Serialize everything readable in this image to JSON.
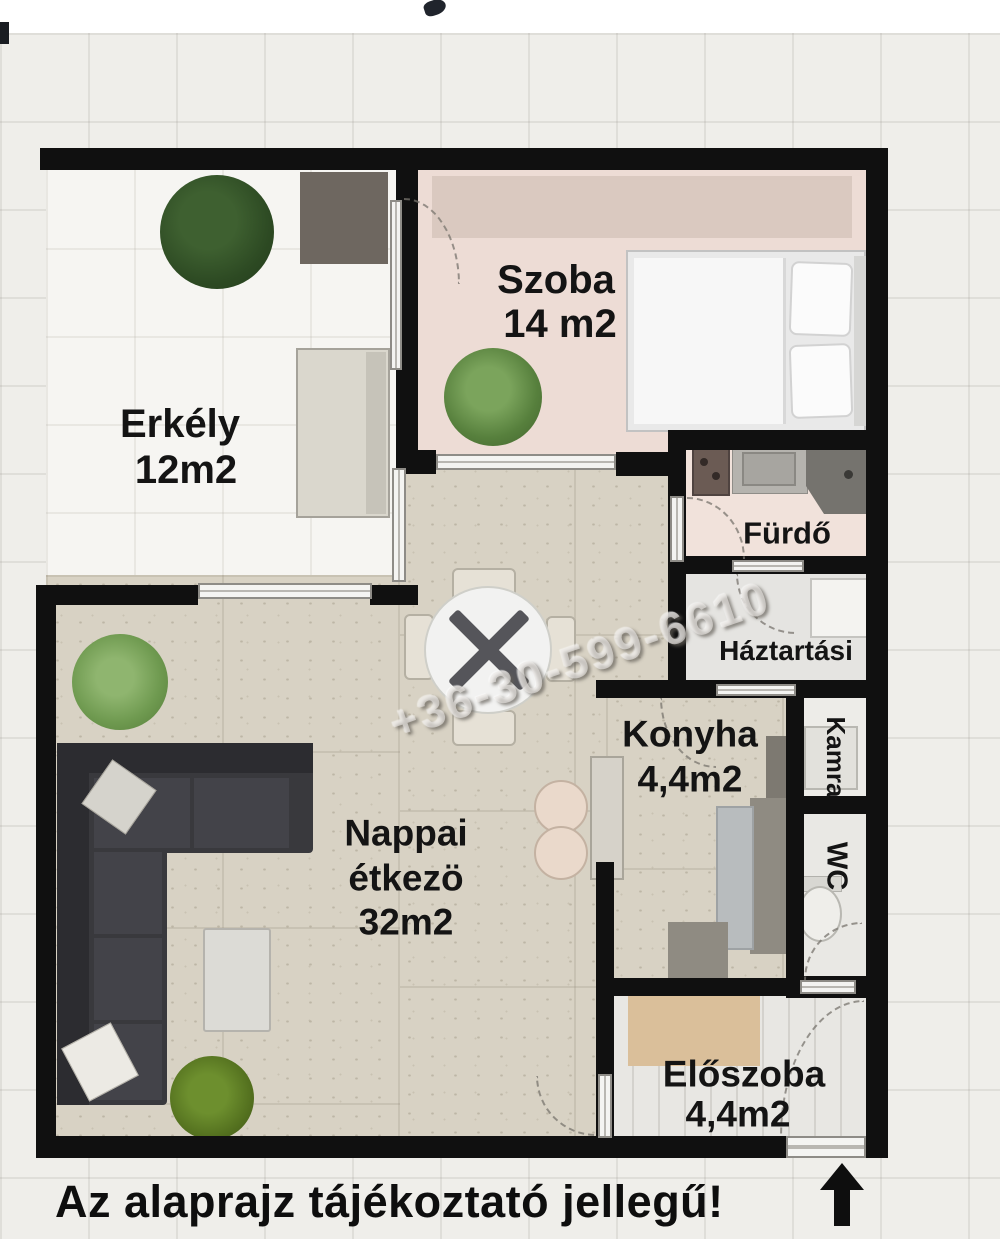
{
  "rooms": {
    "erkely": {
      "name": "Erkély",
      "area": "12m2"
    },
    "szoba": {
      "name": "Szoba",
      "area": "14 m2"
    },
    "furdo": {
      "name": "Fürdő"
    },
    "haztartasi": {
      "name": "Háztartási"
    },
    "kamra": {
      "name": "Kamra"
    },
    "wc": {
      "name": "WC"
    },
    "konyha": {
      "name": "Konyha",
      "area": "4,4m2"
    },
    "nappali": {
      "line1": "Nappai",
      "line2": "étkezö",
      "area": "32m2"
    },
    "eloszoba": {
      "name": "Előszoba",
      "area": "4,4m2"
    }
  },
  "watermark": {
    "text": "+36-30-599-6610"
  },
  "footer": {
    "text": "Az alaprajz tájékoztató jellegű!"
  },
  "colors": {
    "wall": "#101010",
    "szoba_floor": "#eddcd5",
    "living_floor": "#d8d2c4",
    "eloszoba_floor": "#e8e7e3",
    "background": "#efeeea",
    "plant_dark": "#2d4a23",
    "plant_light": "#6f9a50"
  }
}
